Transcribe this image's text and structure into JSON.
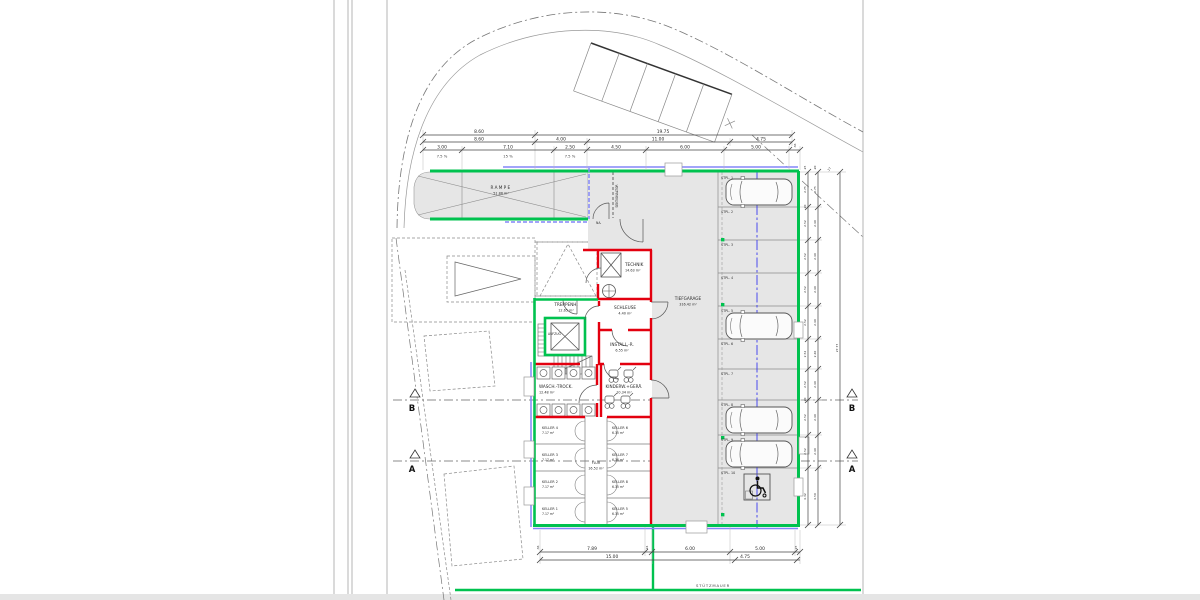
{
  "colors": {
    "wall_green": "#00C24F",
    "wall_red": "#E3000F",
    "overlay_violet": "#8486F8",
    "centerline_blue": "#3A3AF0",
    "floor_gray": "#E6E6E6",
    "line_dark": "#444444",
    "line_light": "#8C8C8C"
  },
  "rooms": {
    "rampe_name": "RAMPE",
    "rampe_area": "51.86 m²",
    "technik_name": "TECHNIK",
    "technik_area": "14.63 m²",
    "treppenhaus_name": "TREPPENH.",
    "treppenhaus_area": "12.65 m²",
    "schleuse_name": "SCHLEUSE",
    "schleuse_area": "4.40 m²",
    "install_name": "INSTALL.-R.",
    "install_area": "6.55 m²",
    "wasch_name": "WASCH.-TROCK.",
    "wasch_area": "12.48 m²",
    "kinderwagen_name": "KINDERW.+GERÄ.",
    "kinderwagen_area": "10.34 m²",
    "flur_name": "FLUR",
    "flur_area": "16.52 m²",
    "tiefgarage_name": "TIEFGARAGE",
    "tiefgarage_area": "316.42 m²",
    "aufzug_name": "AUFZUG",
    "keller": [
      {
        "name": "KELLER 4",
        "area": "7.17 m²"
      },
      {
        "name": "KELLER 3",
        "area": "7.17 m²"
      },
      {
        "name": "KELLER 2",
        "area": "7.17 m²"
      },
      {
        "name": "KELLER 1",
        "area": "7.17 m²"
      },
      {
        "name": "KELLER 6",
        "area": "6.35 m²"
      },
      {
        "name": "KELLER 7",
        "area": "6.36 m²"
      },
      {
        "name": "KELLER 8",
        "area": "6.35 m²"
      },
      {
        "name": "KELLER 5",
        "area": "6.35 m²"
      }
    ]
  },
  "stalls": [
    "STPL. 1",
    "STPL. 2",
    "STPL. 3",
    "STPL. 4",
    "STPL. 5",
    "STPL. 6",
    "STPL. 7",
    "STPL. 8",
    "STPL. 9",
    "STPL. 10"
  ],
  "dims": {
    "top1": [
      "8.60",
      "19.75"
    ],
    "top2": [
      "8.60",
      "4.00",
      "11.00",
      "4.75"
    ],
    "top3": [
      "3.00",
      "7.10",
      "2.50",
      "4.50",
      "6.00",
      "5.00"
    ],
    "top3_wall": ".36",
    "slopes": [
      "7.5 %",
      "15 %",
      "7.5 %"
    ],
    "right_a": [
      "2.75",
      "2.52",
      "2.52",
      "2.52",
      "2.52",
      "2.52",
      "2.52",
      "2.52",
      "2.52",
      "4.32"
    ],
    "right_b": [
      "2.75",
      "2.40",
      "2.40",
      "2.40",
      "2.40",
      "2.40",
      "2.40",
      "2.40",
      "2.40",
      "4.50"
    ],
    "right_small_top": [
      ".25",
      ".20",
      ".17"
    ],
    "right_small_mid": [
      ".20",
      ".20"
    ],
    "right_total": "27.77",
    "bottom1": [
      ".36",
      "7.89",
      ".24",
      "6.00",
      "5.00",
      ".25"
    ],
    "bottom2": [
      "15.00",
      "4.75"
    ]
  },
  "texts": {
    "sektionaltor": "SEKTIONALTOR",
    "na": "NA.",
    "stuetzmauer": "STÜTZMAUER",
    "section_a": "A",
    "section_b": "B"
  }
}
